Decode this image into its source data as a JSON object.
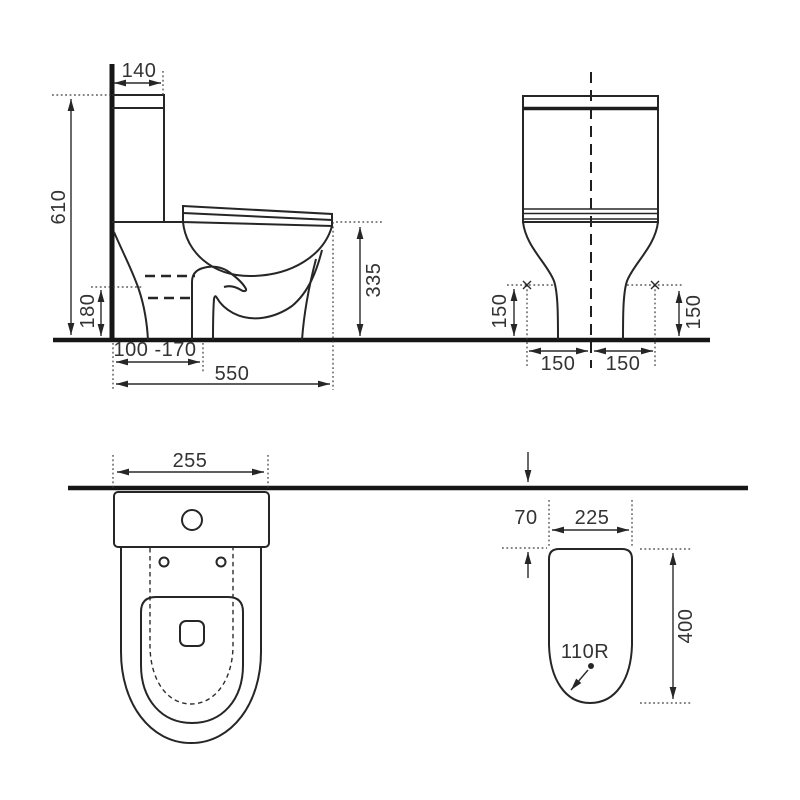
{
  "drawing_title": "toilet-dimension-technical-drawing",
  "colors": {
    "line": "#262626",
    "heavy_line": "#161616",
    "text": "#333333",
    "background": "#ffffff"
  },
  "views": {
    "side": {
      "tank_depth": "140",
      "overall_height": "610",
      "outlet_height": "180",
      "bowl_height": "335",
      "outlet_range": "100 -170",
      "overall_depth": "550"
    },
    "front": {
      "left_clearance_height": "150",
      "right_clearance_height": "150",
      "left_half_width": "150",
      "right_half_width": "150"
    },
    "plan": {
      "tank_width": "255"
    },
    "footprint": {
      "wall_gap": "70",
      "base_width": "225",
      "base_length": "400",
      "corner_radius": "110R"
    }
  }
}
